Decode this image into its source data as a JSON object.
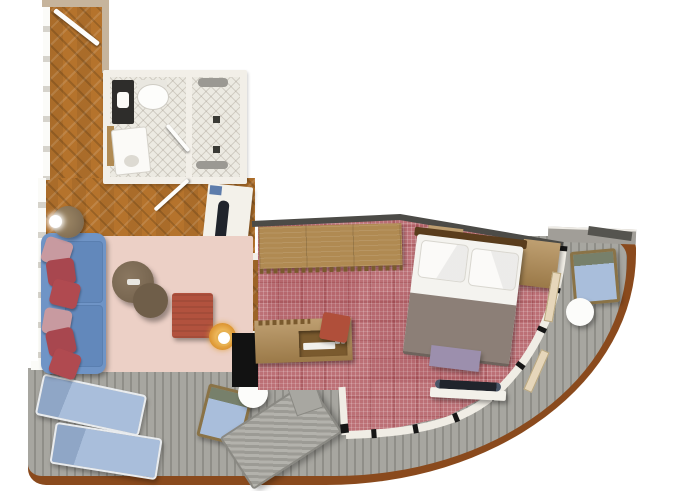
{
  "meta": {
    "kind": "floor-plan",
    "subject": "cruise-suite-with-wrap-around-balcony",
    "canvas": {
      "width": 680,
      "height": 491
    },
    "visible_text": []
  },
  "palette": {
    "wood": "#b5732c",
    "wood_dark": "#8f5a1d",
    "wood_furniture": "#b08a52",
    "wood_furniture_dark": "#7a5a2e",
    "carpet": "#bc7076",
    "carpet_shade": "#8c2830",
    "deck": "#a7a6a0",
    "deck_gap": "#8f8e88",
    "rim": "#8a4a1d",
    "wall_white": "#f2efe8",
    "wall_grey": "#d6d3cb",
    "wall_tan": "#c6b49c",
    "wall_dark": "#4c4b47",
    "wall_black": "#121212",
    "tile": "#eceae2",
    "sofa": "#6f94c6",
    "seat": "#6288bb",
    "pillow_red": "#b04a50",
    "pillow_dark_red": "#a8474f",
    "pillow_pink": "#c89aa0",
    "rug": "#ecd0c6",
    "table_brown": "#6f5e49",
    "ottoman": "#b2523e",
    "lamp_gold": "#e09c35",
    "mattress": "#f4f3ef",
    "runner": "#8c7f77",
    "headboard": "#5a3d1d",
    "bench": "#9c8fad",
    "tv": "#20242c",
    "lounger": "#a9bedb",
    "daybed": "#a8a7a1",
    "door_leaf": "#e6d6ba",
    "shelf_white": "#f3f1ea"
  },
  "rooms": {
    "hallway": {
      "floor": "herringbone-wood",
      "features": [
        "entrance-door"
      ]
    },
    "bathroom": {
      "floor": "white-tile",
      "fixtures": [
        "dark-vanity-cabinet",
        "toilet",
        "sink-unit",
        "wood-shelf",
        "door-to-hallway",
        "door-to-shower"
      ]
    },
    "shower_room": {
      "floor": "white-tile",
      "fixtures": [
        "shower-fixture-top",
        "shower-fixture-bottom",
        "drain",
        "drain"
      ]
    },
    "living_room": {
      "floor": "herringbone-wood",
      "furniture": [
        "blue-sofa",
        "six-throw-pillows",
        "floor-lamp",
        "pink-area-rug",
        "round-coffee-table-large",
        "round-coffee-table-small",
        "red-ottoman",
        "gold-floor-lamp",
        "tv-cabinet-with-tv"
      ]
    },
    "bedroom": {
      "floor": "rose-carpet",
      "furniture": [
        "wardrobe-with-hanger-rail",
        "double-bed-white-duvet-grey-runner",
        "nightstand-left",
        "nightstand-right",
        "purple-foot-bench",
        "wall-tv-on-shelf",
        "desk-console",
        "red-desk-chair",
        "open-balcony-door-leaf",
        "open-balcony-door-leaf"
      ]
    },
    "balcony": {
      "floor": "grey-plank-deck",
      "edge": "curved-brown-rail",
      "furniture": [
        "sun-lounger",
        "sun-lounger",
        "deck-chair",
        "white-round-table",
        "net-daybed",
        "armchair",
        "white-round-table"
      ]
    }
  }
}
